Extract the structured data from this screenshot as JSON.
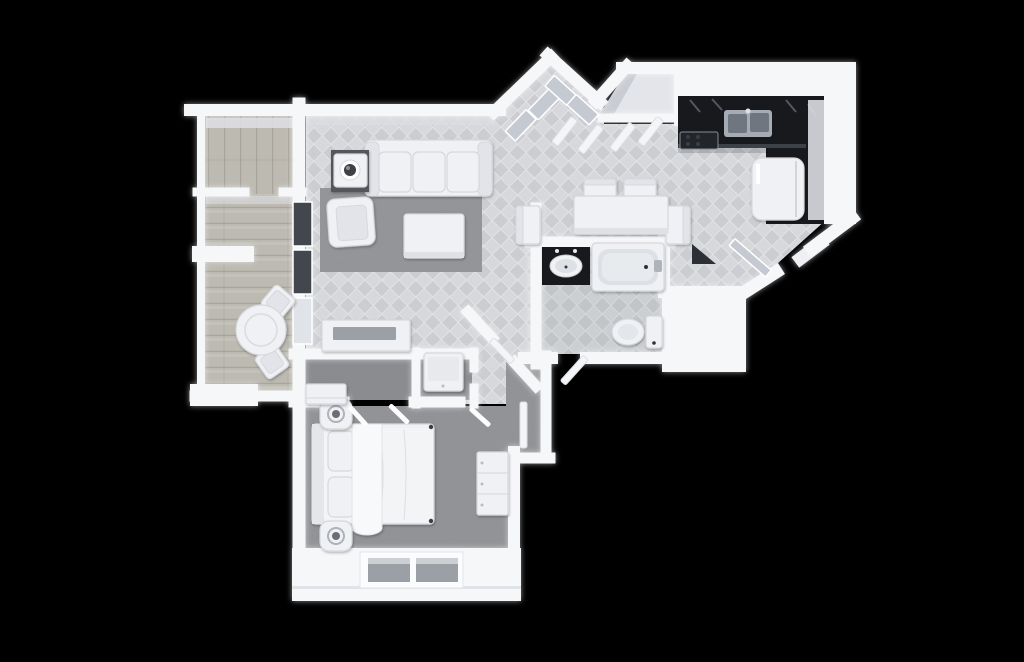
{
  "scene": {
    "title": "3D top-down floor plan rendering of a one-bedroom apartment on a black background",
    "view": "top-down 3D render",
    "background": "#000000"
  },
  "palette": {
    "background": "#000000",
    "wall": "#f6f7f9",
    "wall_face": "#dbdde2",
    "tile_base": "#cbcdd1",
    "tile_alt": "#d6d8db",
    "tile_line": "#e0e2e5",
    "wood_base": "#bdbab2",
    "wood_line": "#a49f96",
    "carpet": "#5e6063",
    "carpet_dark": "#47494c",
    "rug": "#6a6d70",
    "counter": "#17191d",
    "counter_edge": "#3c4047",
    "glass_window": "#42474e",
    "glass_panel": "#c5cad2",
    "furniture_white": "#f0f1f4",
    "furniture_soft": "#e2e4e9",
    "furniture_stroke": "#d5d8dc",
    "tv": "#9ba0a6",
    "appliance": "#a6acb4",
    "basin": "#70767f"
  },
  "rooms": [
    {
      "id": "living-room",
      "label": "Living Room",
      "floor": "tile"
    },
    {
      "id": "dining-area",
      "label": "Dining Area",
      "floor": "tile"
    },
    {
      "id": "kitchen",
      "label": "Kitchen",
      "floor": "tile"
    },
    {
      "id": "entry-closets",
      "label": "Entry Closets",
      "floor": "tile"
    },
    {
      "id": "bathroom",
      "label": "Bathroom",
      "floor": "tile"
    },
    {
      "id": "hallway",
      "label": "Hallway",
      "floor": "tile"
    },
    {
      "id": "bedroom",
      "label": "Bedroom",
      "floor": "carpet"
    },
    {
      "id": "bedroom-closet",
      "label": "Bedroom Closet",
      "floor": "carpet"
    },
    {
      "id": "laundry-closet",
      "label": "Laundry Closet",
      "floor": "carpet"
    },
    {
      "id": "balcony",
      "label": "Balcony",
      "floor": "wood"
    },
    {
      "id": "balcony-storage",
      "label": "Balcony Storage",
      "floor": "wood"
    }
  ],
  "furniture": [
    "sofa",
    "area-rug",
    "coffee-table",
    "armchair",
    "plant-side-table",
    "tv-console",
    "dining-table",
    "dining-chairs",
    "kitchen-counter",
    "kitchen-sink",
    "stove",
    "refrigerator",
    "bathroom-vanity",
    "bathtub",
    "toilet",
    "bed",
    "nightstands",
    "dresser",
    "washer",
    "closet-hangers",
    "closet-shelf",
    "balcony-table",
    "balcony-chairs",
    "entry-mirror-panels",
    "closet-bifold-doors",
    "glass-entry-door",
    "door-leaves",
    "windows"
  ]
}
